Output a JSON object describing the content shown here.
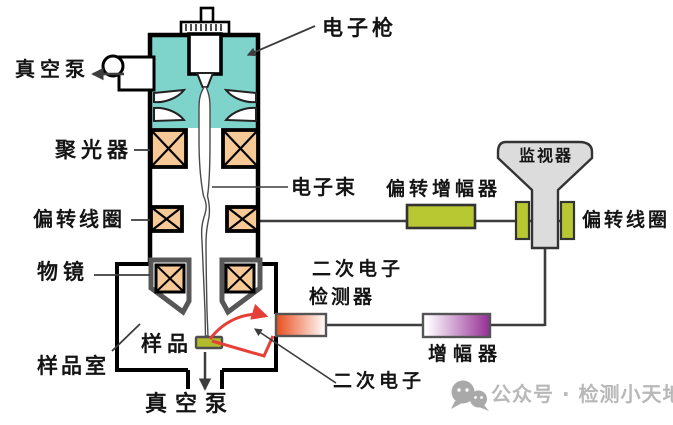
{
  "labels": {
    "electron_gun": "电子枪",
    "vacuum_pump_top": "真空泵",
    "condenser": "聚光器",
    "electron_beam": "电子束",
    "deflection_coil_column": "偏转线圈",
    "objective_lens": "物镜",
    "sample": "样品",
    "sample_chamber": "样品室",
    "vacuum_pump_bottom": "真空泵",
    "deflection_amplifier": "偏转增幅器",
    "monitor": "监视器",
    "deflection_coil_crt": "偏转线圈",
    "se_detector_line1": "二次电子",
    "se_detector_line2": "检测器",
    "amplifier": "增幅器",
    "secondary_electron": "二次电子"
  },
  "watermark": {
    "text": "公众号 · 检测小天地"
  },
  "colors": {
    "teal": "#7ed3ca",
    "coil_orange": "#f6c997",
    "lens_gray": "#575757",
    "green": "#b7c832",
    "sample_green": "#b2bb2b",
    "detector_orange": "#e84d1c",
    "amp_purple": "#942e94",
    "red": "#e63f38",
    "monitor_gray": "#dcdcdc",
    "line_dark": "#3d3d3d",
    "watermark_gray": "#b8b8b8"
  }
}
